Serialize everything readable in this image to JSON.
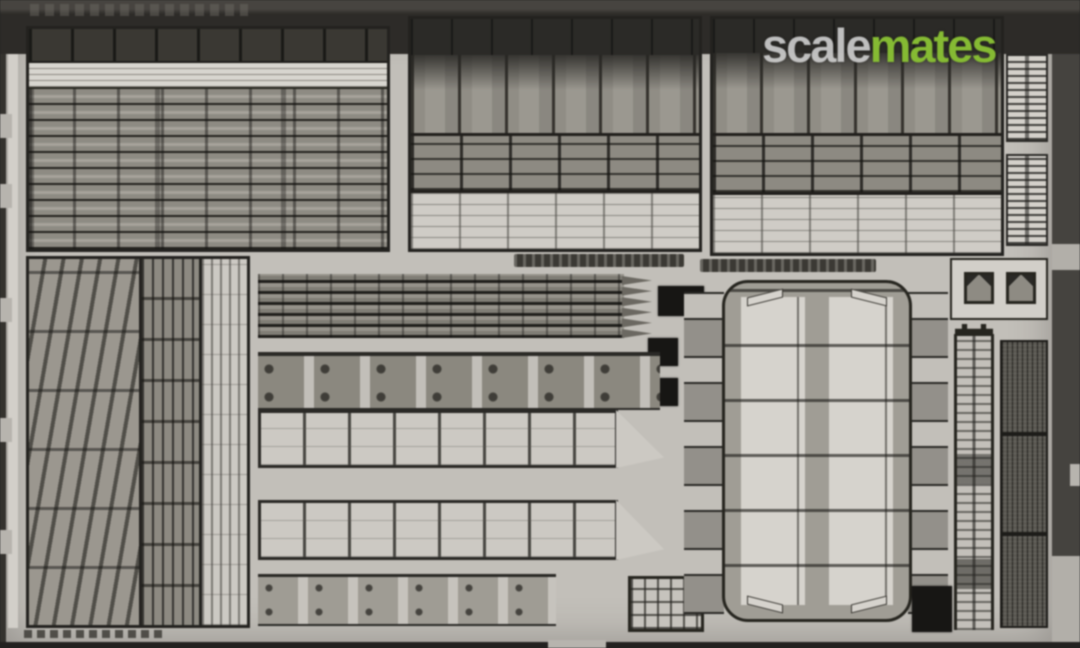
{
  "subject": "Product photograph of a photo-etched metal detail fret for a scale model kit",
  "watermark": {
    "scale": "scale",
    "mates": "mates"
  },
  "colors": {
    "background": "#34322e",
    "top_band_light": "#474440",
    "top_band_dark": "#2d2b28",
    "fret_metal": "#c2bfb9",
    "metal_bright": "#d6d3cd",
    "metal_mid": "#908d85",
    "metal_dark": "#514f49",
    "etch_black": "#171614",
    "logo_gray": "#d3d3d3",
    "logo_green": "#83bb2d"
  }
}
